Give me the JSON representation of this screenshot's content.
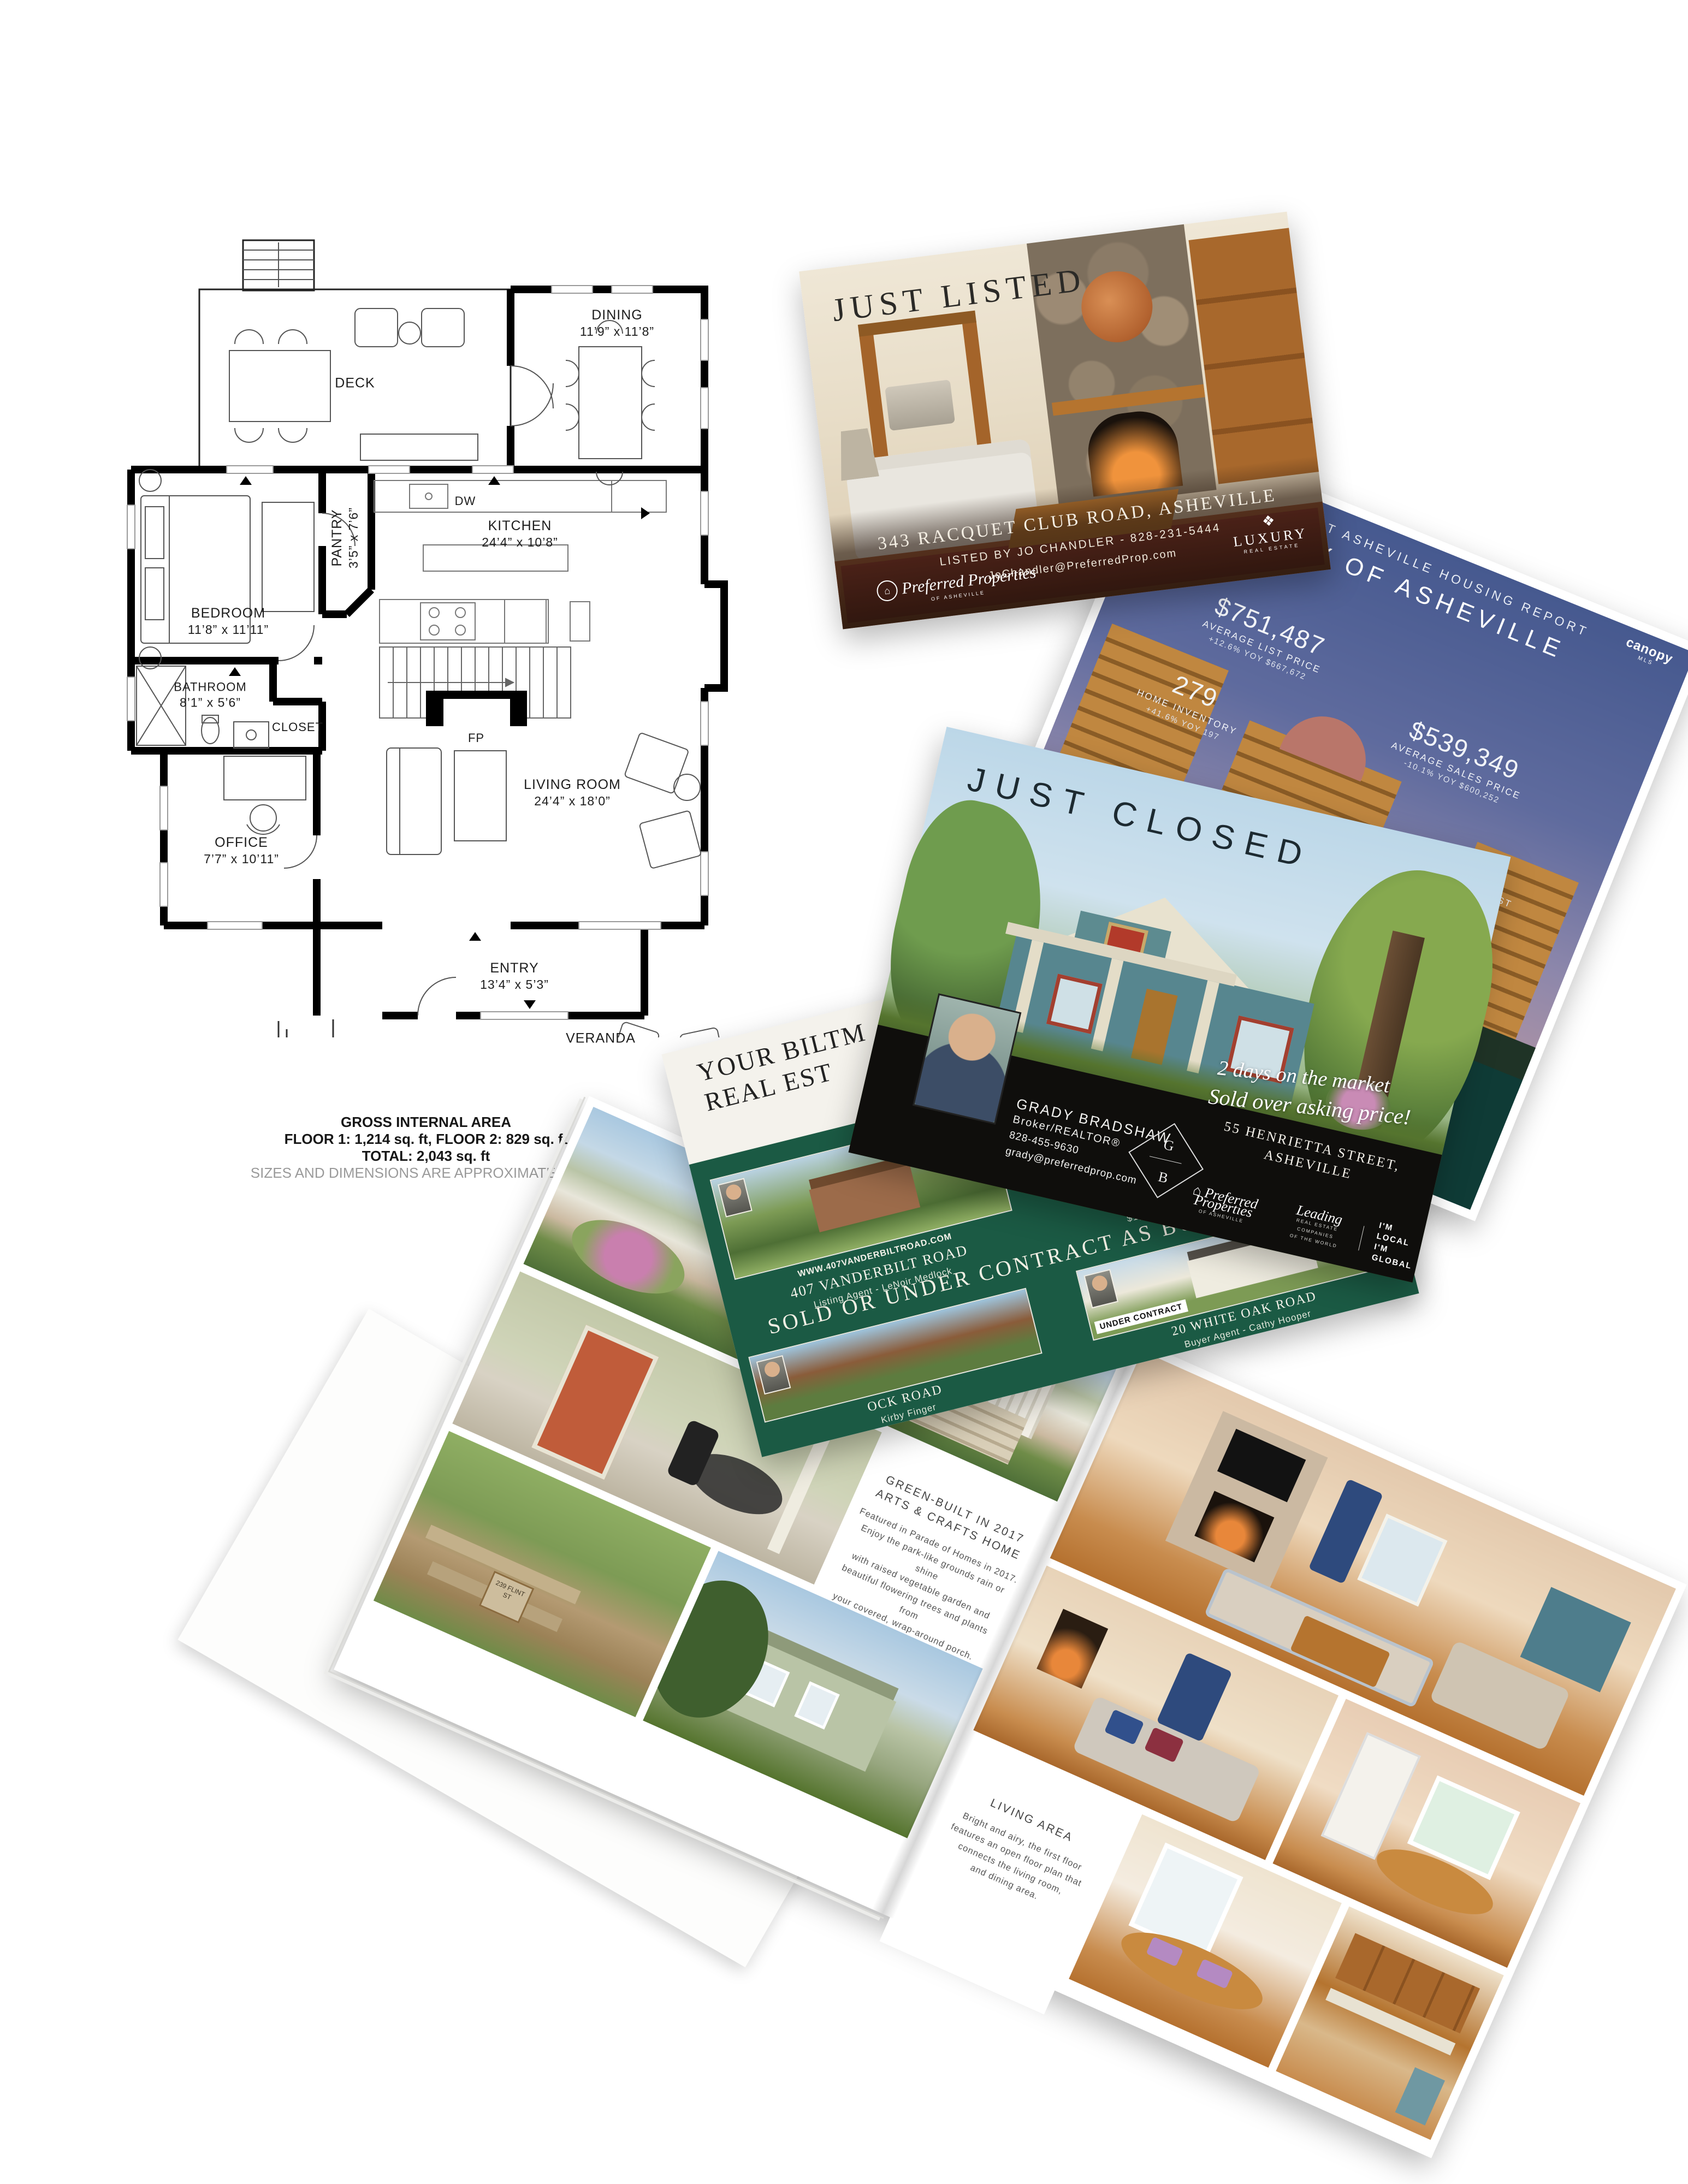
{
  "floor_plan": {
    "rooms": [
      {
        "name": "DECK",
        "dims": ""
      },
      {
        "name": "DINING",
        "dims": "11’9” x 11’8”"
      },
      {
        "name": "KITCHEN",
        "dims": "24’4” x 10’8”"
      },
      {
        "name": "PANTRY",
        "dims": "3’5” x 7’6”"
      },
      {
        "name": "BEDROOM",
        "dims": "11’8” x 11’11”"
      },
      {
        "name": "BATHROOM",
        "dims": "8’1” x 5’6”"
      },
      {
        "name": "CLOSET",
        "dims": ""
      },
      {
        "name": "OFFICE",
        "dims": "7’7” x 10’11”"
      },
      {
        "name": "LIVING ROOM",
        "dims": "24’4” x 18’0”"
      },
      {
        "name": "ENTRY",
        "dims": "13’4” x 5’3”"
      },
      {
        "name": "VERANDA",
        "dims": ""
      }
    ],
    "appliance_labels": {
      "dishwasher": "DW",
      "fireplace": "FP"
    },
    "footer": {
      "title": "GROSS INTERNAL AREA",
      "floors": "FLOOR 1: 1,214 sq. ft, FLOOR 2: 829 sq. ft",
      "total": "TOTAL: 2,043 sq. ft",
      "disclaimer": "SIZES AND DIMENSIONS ARE APPROXIMATE, ACTU"
    }
  },
  "just_listed": {
    "title": "JUST LISTED",
    "address": "343 RACQUET CLUB ROAD, ASHEVILLE",
    "listed_by": "LISTED BY JO CHANDLER - 828-231-5444",
    "email": "JoChandler@PreferredProp.com",
    "brand": {
      "emblem": "⌂",
      "name": "Preferred Properties",
      "sub": "OF ASHEVILLE"
    },
    "luxury": {
      "ornament": "❖",
      "word": "LUXURY",
      "sub": "REAL ESTATE"
    }
  },
  "housing_report": {
    "header": "CURRENT ASHEVILLE HOUSING REPORT",
    "mls": {
      "name": "canopy",
      "sub": "MLS"
    },
    "city": "CITY OF ASHEVILLE",
    "stats": [
      {
        "value": "$751,487",
        "label": "AVERAGE LIST PRICE",
        "yoy": "+12.6% YOY $667,672"
      },
      {
        "value": "279",
        "label": "HOME INVENTORY",
        "yoy": "+41.6% YOY 197"
      },
      {
        "value": "$539,349",
        "label": "AVERAGE SALES PRICE",
        "yoy": "-10.1% YOY $600,252"
      },
      {
        "value": "99.0%",
        "label": "% OF ORIGINAL LIST PRICE RECEIVED",
        "yoy": "-3.9% YOY 103.0%"
      }
    ],
    "banner_title": "COMBINING AUTHENTIC, LOCAL EXPERTISE",
    "banner_lines": [
      "Preferred Properties of Asheville has a long-standi",
      "our firm has extensive knowledge of the",
      "reputation for providing quali"
    ]
  },
  "just_closed": {
    "title": "JUST CLOSED",
    "agent": {
      "name": "GRADY BRADSHAW",
      "role": "Broker/REALTOR®",
      "phone": "828-455-9630",
      "email": "grady@preferredprop.com",
      "monogram_top": "G",
      "monogram_bottom": "B"
    },
    "script_line1": "2 days on the market",
    "script_line2": "Sold over asking price!",
    "address": "55 HENRIETTA STREET, ASHEVILLE",
    "brands": {
      "preferred": {
        "emblem": "⌂",
        "name": "Preferred Properties",
        "sub": "OF ASHEVILLE"
      },
      "leading": {
        "name": "Leading",
        "sub1": "REAL ESTATE COMPANIES",
        "sub2": "OF THE WORLD"
      },
      "local_global": {
        "line1": "I'M LOCAL",
        "line2": "I'M GLOBAL"
      }
    }
  },
  "listings_card": {
    "headline_line1": "YOUR BILTM",
    "headline_line2": "REAL EST",
    "listings_header": "LIST",
    "listings": [
      {
        "badge": "",
        "url": "WWW.407VANDERBILTROAD.COM",
        "address": "407 VANDERBILT ROAD",
        "agent": "Listing Agent - LeNoir Medlock"
      },
      {
        "badge": "ACTIVE LISTING",
        "url": "WWW.4STUYVESANTCRESCENT.COM",
        "address": "4 STUYVESANT CRESCENT",
        "agent": "$1,550,000   Listing Agent - Jo Chandler"
      }
    ],
    "banner": "SOLD OR UNDER CONTRACT AS BUYER AGENTS",
    "sold_listings": [
      {
        "badge": "",
        "address": "OCK ROAD",
        "agent": "Kirby Finger"
      },
      {
        "badge": "UNDER CONTRACT",
        "address": "20 WHITE OAK ROAD",
        "agent": "Buyer Agent - Cathy Hooper"
      }
    ]
  },
  "brochure": {
    "left_panel": {
      "title_line1": "GREEN-BUILT IN 2017",
      "title_line2": "ARTS & CRAFTS HOME",
      "body": [
        "Featured in Parade of Homes in 2017.",
        "Enjoy the park-like grounds rain or shine",
        "with raised vegetable garden and",
        "beautiful flowering trees and plants from",
        "your covered, wrap-around porch."
      ]
    },
    "right_panel": {
      "title": "LIVING AREA",
      "body": [
        "Bright and airy, the first floor",
        "features an open floor plan that",
        "connects the living room,",
        "and dining area."
      ]
    },
    "house_number": "239",
    "sign": "239 FLINT ST"
  },
  "colors": {
    "card_green": "#1b5a44",
    "band_black": "#0f0e0c",
    "report_teal": "#0f3b36",
    "report_blue": "#46598f"
  }
}
